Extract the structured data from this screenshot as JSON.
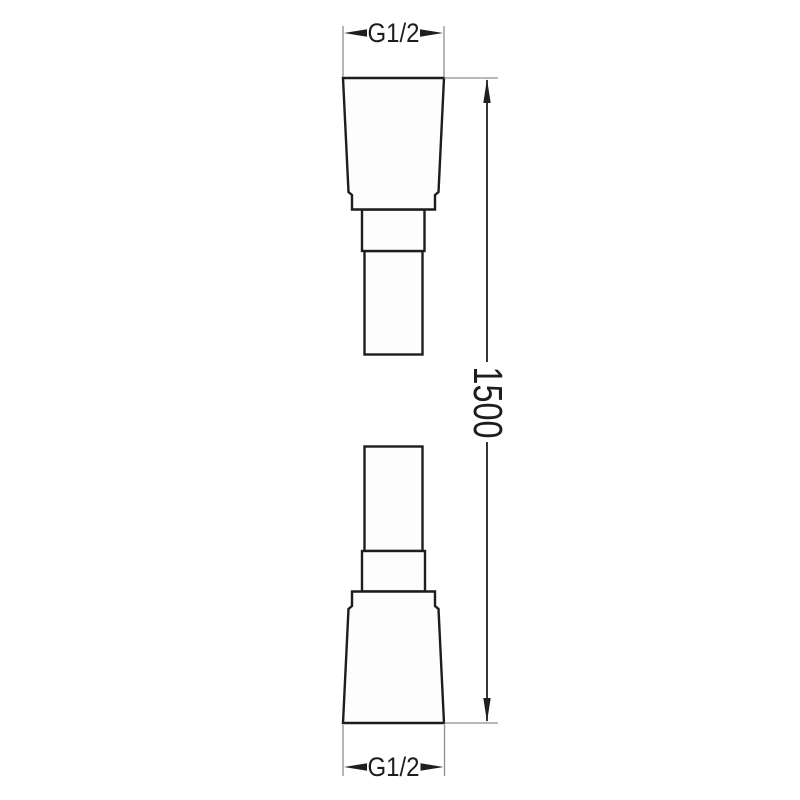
{
  "drawing": {
    "labels": {
      "top_thread": "G1/2",
      "bottom_thread": "G1/2",
      "hose_length": "1500"
    },
    "colors": {
      "background": "#ffffff",
      "part_outline": "#1d1d1d",
      "part_fill": "#fdfdfd",
      "dimension_line": "#1f1f1f",
      "extension_line": "#8f8f8f",
      "text": "#1d1d1d"
    }
  }
}
